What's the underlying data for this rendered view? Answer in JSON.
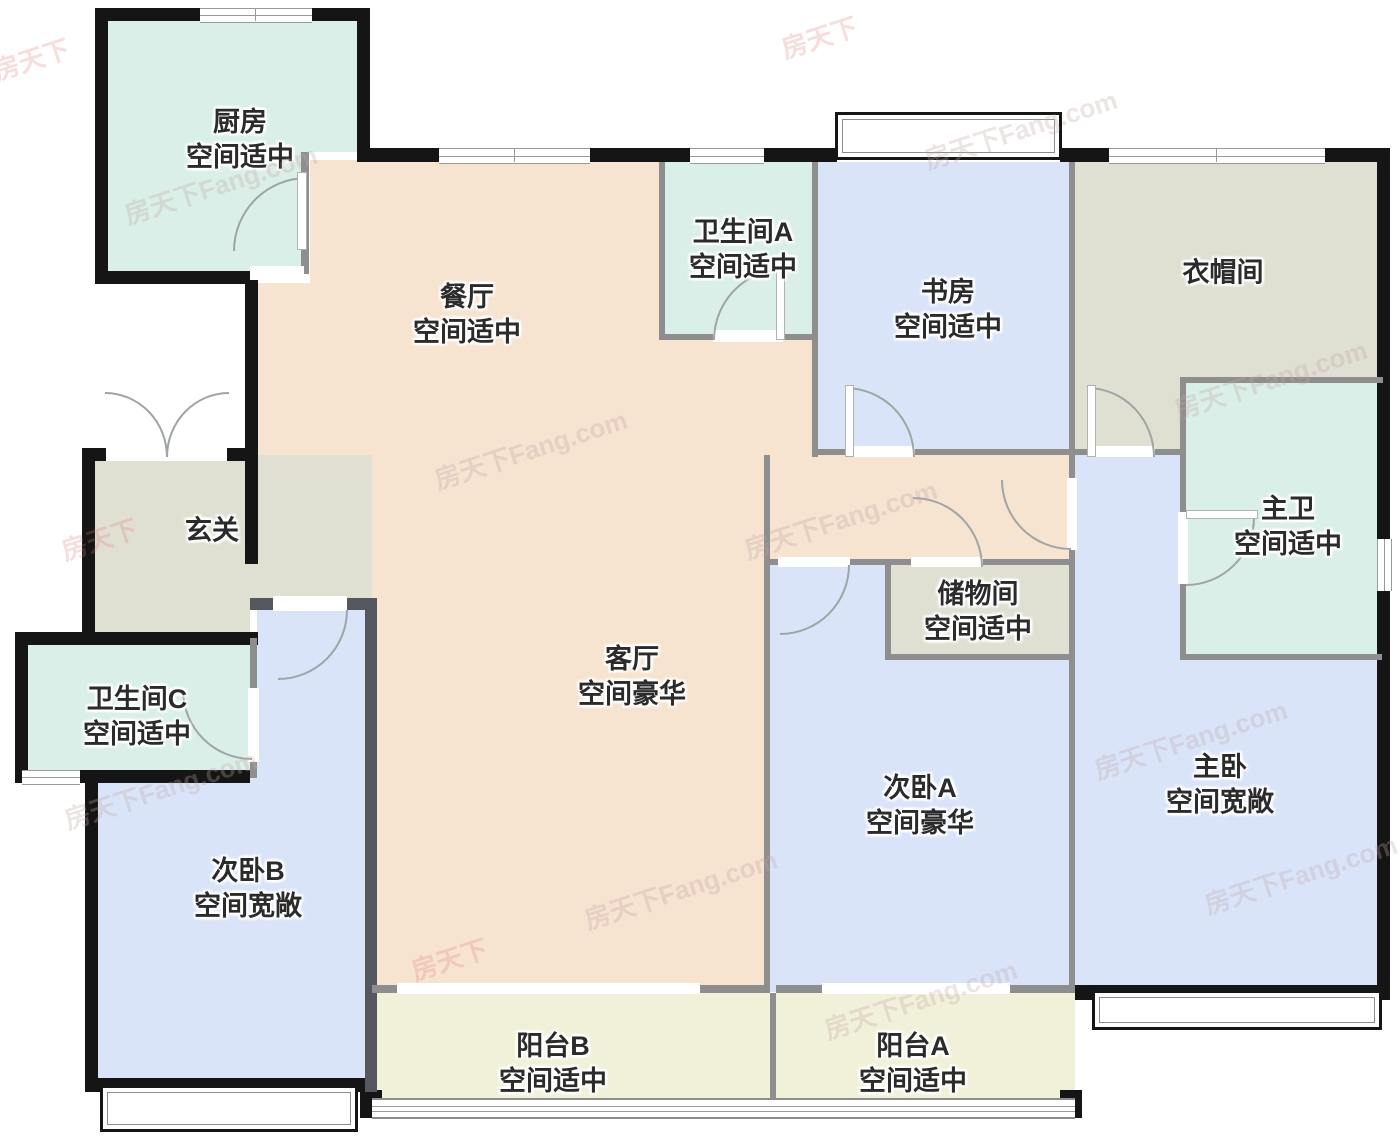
{
  "title": "户型图",
  "watermark": {
    "text": "房天下Fang.com",
    "text_short": "房天下"
  },
  "palette": {
    "wall_exterior": "#151515",
    "wall_interior": "#8e8e8e",
    "wall_dark": "#54585e",
    "room_teal": "#d9efe7",
    "room_blue": "#d9e4f9",
    "room_peach": "#f6e3d0",
    "room_beige": "#dfdfd2",
    "room_cream": "#f1f1d9",
    "label_color": "#2b2b2b"
  },
  "rooms": {
    "kitchen": {
      "name": "厨房",
      "grade": "空间适中"
    },
    "dining": {
      "name": "餐厅",
      "grade": "空间适中"
    },
    "bath_a": {
      "name": "卫生间A",
      "grade": "空间适中"
    },
    "study": {
      "name": "书房",
      "grade": "空间适中"
    },
    "cloakroom": {
      "name": "衣帽间",
      "grade": ""
    },
    "entry": {
      "name": "玄关",
      "grade": ""
    },
    "master_bath": {
      "name": "主卫",
      "grade": "空间适中"
    },
    "storage": {
      "name": "储物间",
      "grade": "空间适中"
    },
    "living": {
      "name": "客厅",
      "grade": "空间豪华"
    },
    "bath_c": {
      "name": "卫生间C",
      "grade": "空间适中"
    },
    "bedroom_b": {
      "name": "次卧B",
      "grade": "空间宽敞"
    },
    "bedroom_a": {
      "name": "次卧A",
      "grade": "空间豪华"
    },
    "master_bedroom": {
      "name": "主卧",
      "grade": "空间宽敞"
    },
    "balcony_b": {
      "name": "阳台B",
      "grade": "空间适中"
    },
    "balcony_a": {
      "name": "阳台A",
      "grade": "空间适中"
    }
  }
}
